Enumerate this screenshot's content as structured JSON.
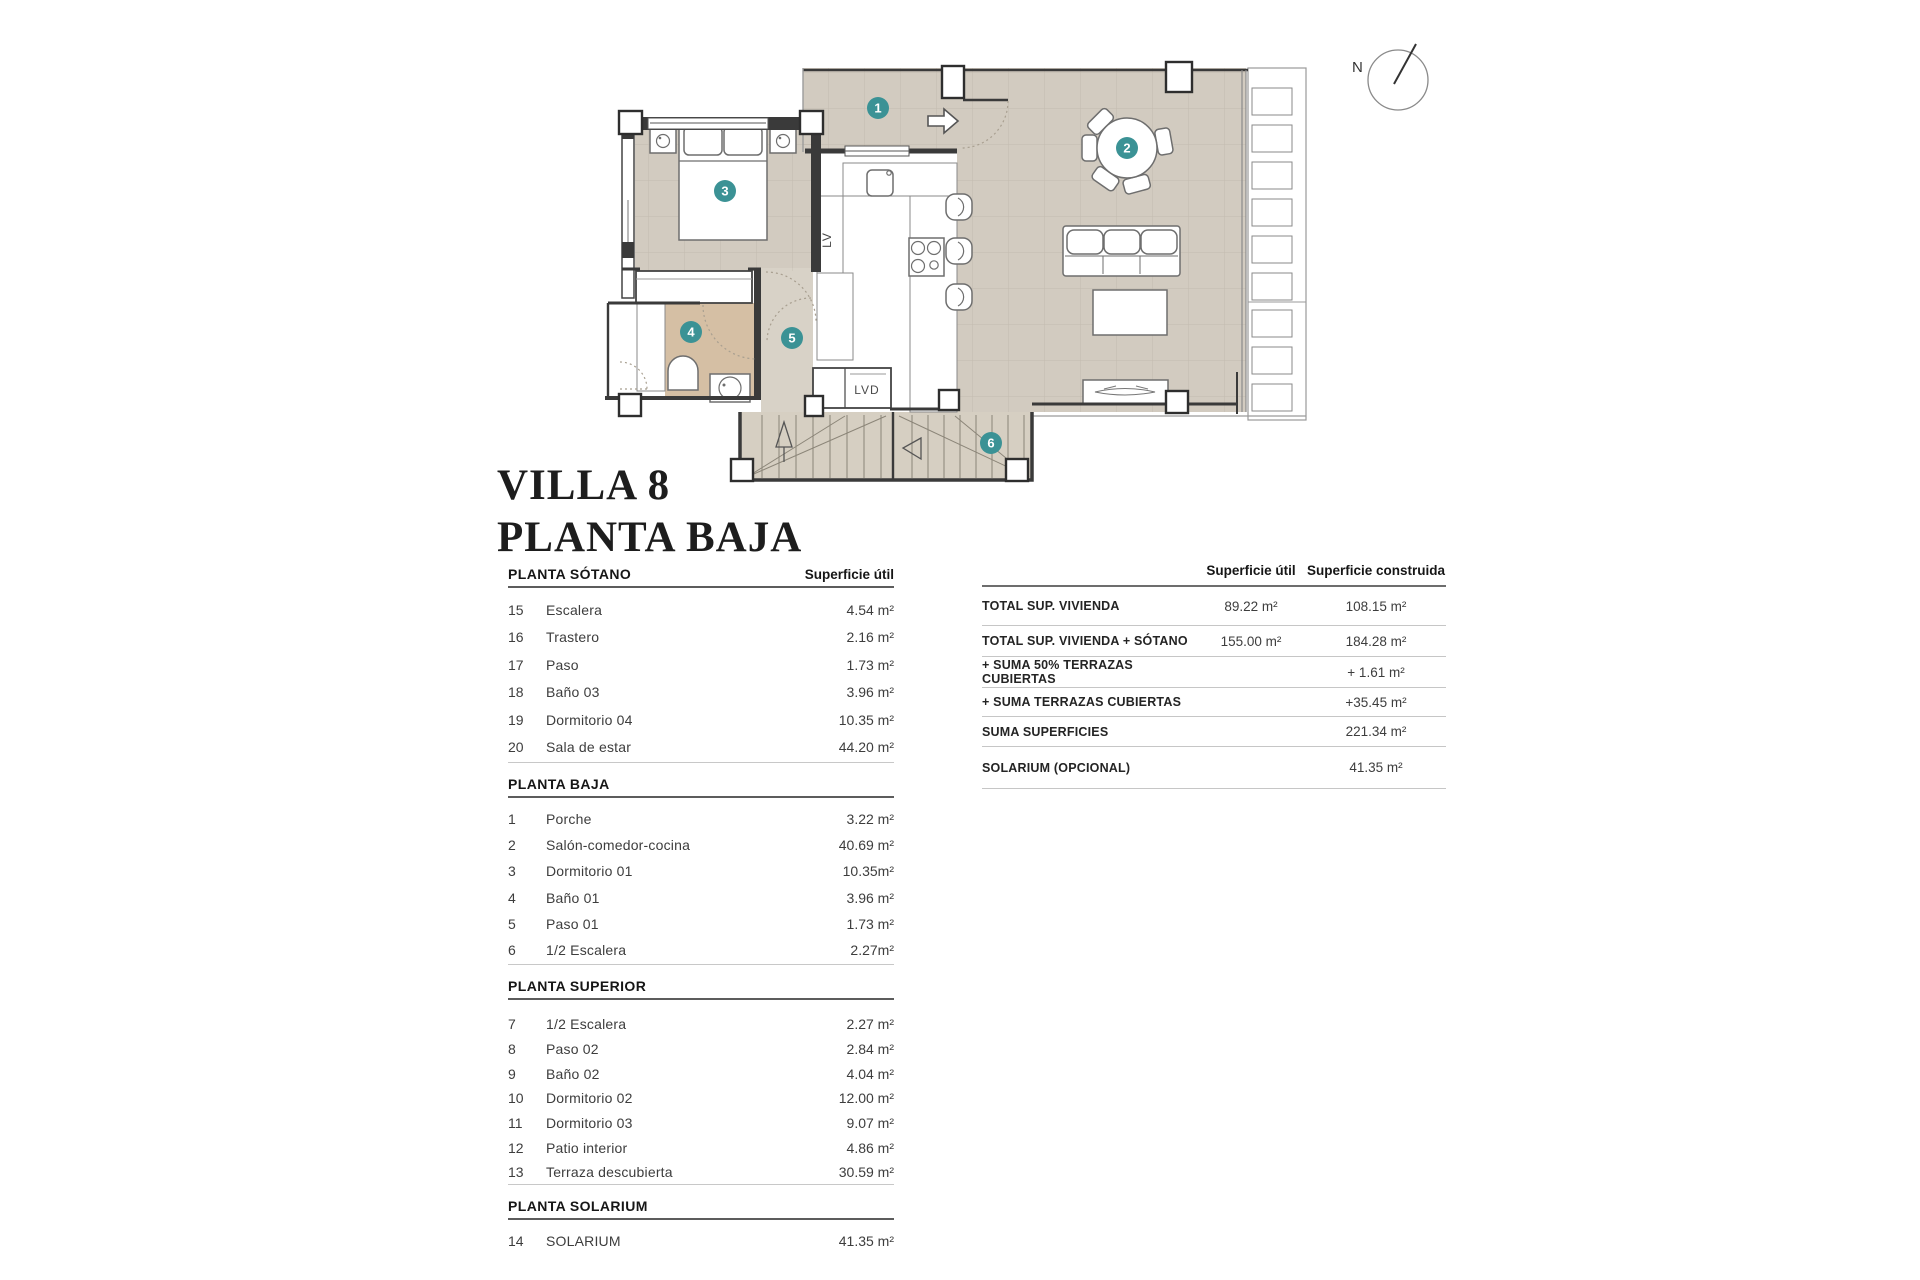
{
  "title": {
    "line1": "VILLA 8",
    "line2": "PLANTA BAJA"
  },
  "compass": {
    "label": "N"
  },
  "plan": {
    "badges": [
      "1",
      "2",
      "3",
      "4",
      "5",
      "6"
    ],
    "labels": {
      "lv": "LV",
      "lvd": "LVD"
    }
  },
  "sections": [
    {
      "header": "PLANTA SÓTANO",
      "value_col": "Superficie útil",
      "rows": [
        {
          "num": "15",
          "name": "Escalera",
          "value": "4.54 m²"
        },
        {
          "num": "16",
          "name": "Trastero",
          "value": "2.16 m²"
        },
        {
          "num": "17",
          "name": "Paso",
          "value": "1.73 m²"
        },
        {
          "num": "18",
          "name": "Baño 03",
          "value": "3.96 m²"
        },
        {
          "num": "19",
          "name": "Dormitorio 04",
          "value": "10.35 m²"
        },
        {
          "num": "20",
          "name": "Sala de estar",
          "value": "44.20 m²"
        }
      ]
    },
    {
      "header": "PLANTA BAJA",
      "rows": [
        {
          "num": "1",
          "name": "Porche",
          "value": "3.22 m²"
        },
        {
          "num": "2",
          "name": "Salón-comedor-cocina",
          "value": "40.69 m²"
        },
        {
          "num": "3",
          "name": "Dormitorio 01",
          "value": "10.35m²"
        },
        {
          "num": "4",
          "name": "Baño 01",
          "value": "3.96 m²"
        },
        {
          "num": "5",
          "name": "Paso 01",
          "value": "1.73 m²"
        },
        {
          "num": "6",
          "name": "1/2 Escalera",
          "value": "2.27m²"
        }
      ]
    },
    {
      "header": "PLANTA SUPERIOR",
      "rows": [
        {
          "num": "7",
          "name": "1/2 Escalera",
          "value": "2.27 m²"
        },
        {
          "num": "8",
          "name": "Paso 02",
          "value": "2.84 m²"
        },
        {
          "num": "9",
          "name": "Baño 02",
          "value": "4.04 m²"
        },
        {
          "num": "10",
          "name": "Dormitorio 02",
          "value": "12.00 m²"
        },
        {
          "num": "11",
          "name": "Dormitorio 03",
          "value": "9.07 m²"
        },
        {
          "num": "12",
          "name": "Patio interior",
          "value": "4.86 m²"
        },
        {
          "num": "13",
          "name": "Terraza descubierta",
          "value": "30.59 m²"
        }
      ]
    },
    {
      "header": "PLANTA SOLARIUM",
      "rows": [
        {
          "num": "14",
          "name": "SOLARIUM",
          "value": "41.35 m²"
        }
      ]
    }
  ],
  "summary": {
    "col_util": "Superficie útil",
    "col_built": "Superficie construida",
    "rows": [
      {
        "label": "TOTAL SUP. VIVIENDA",
        "util": "89.22 m²",
        "built": "108.15 m²"
      },
      {
        "label": "TOTAL SUP. VIVIENDA + SÓTANO",
        "util": "155.00 m²",
        "built": "184.28 m²"
      },
      {
        "label": "+ SUMA 50% TERRAZAS CUBIERTAS",
        "util": "",
        "built": "+ 1.61 m²"
      },
      {
        "label": "+ SUMA TERRAZAS CUBIERTAS",
        "util": "",
        "built": "+35.45 m²"
      },
      {
        "label": "SUMA SUPERFICIES",
        "util": "",
        "built": "221.34 m²"
      },
      {
        "label": "SOLARIUM (OPCIONAL)",
        "util": "",
        "built": "41.35 m²"
      }
    ]
  },
  "colors": {
    "badge": "#3b9295",
    "floor": "#d2cbc0",
    "bath": "#d5bfa4"
  }
}
